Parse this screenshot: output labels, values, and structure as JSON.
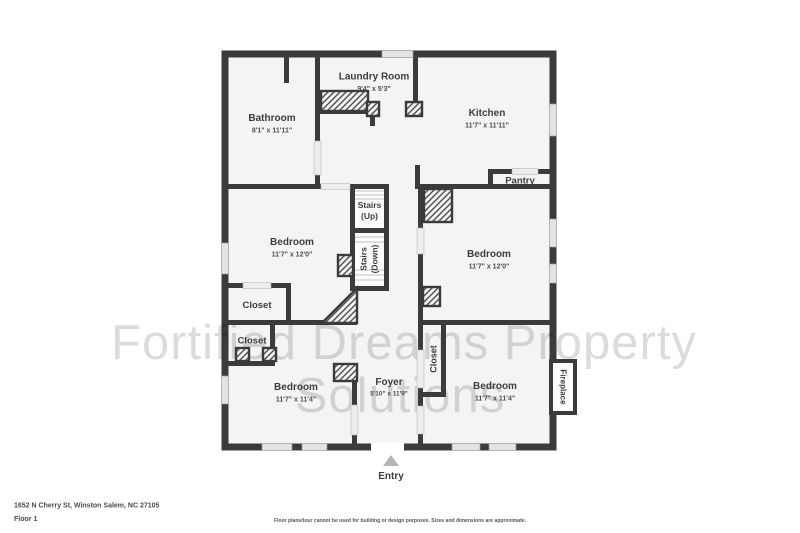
{
  "watermark": {
    "line1": "Fortified Dreams Property",
    "line2": "Solutions"
  },
  "rooms": {
    "bathroom": {
      "name": "Bathroom",
      "dims": "8'1\" x 11'11\""
    },
    "laundry": {
      "name": "Laundry Room",
      "dims": "9'4\" x 5'3\""
    },
    "kitchen": {
      "name": "Kitchen",
      "dims": "11'7\" x 11'11\""
    },
    "pantry": {
      "name": "Pantry"
    },
    "stairs_up": {
      "name": "Stairs",
      "name2": "(Up)"
    },
    "stairs_down": {
      "name": "Stairs",
      "name2": "(Down)"
    },
    "bedroom_left": {
      "name": "Bedroom",
      "dims": "11'7\" x 12'0\""
    },
    "bedroom_right": {
      "name": "Bedroom",
      "dims": "11'7\" x 12'0\""
    },
    "closet_mid": {
      "name": "Closet"
    },
    "closet_small": {
      "name": "Closet"
    },
    "bedroom_bottom_left": {
      "name": "Bedroom",
      "dims": "11'7\" x 11'4\""
    },
    "foyer": {
      "name": "Foyer",
      "dims": "5'10\" x 11'9\""
    },
    "closet_foyer": {
      "name": "Closet"
    },
    "bedroom_bottom_right": {
      "name": "Bedroom",
      "dims": "11'7\" x 11'4\""
    },
    "fireplace": {
      "name": "Fireplace"
    }
  },
  "entry": {
    "label": "Entry"
  },
  "footer": {
    "address": "1652 N Cherry St, Winston Salem, NC 27105",
    "floor_label": "Floor 1",
    "disclaimer": "Floor plans/tour cannot be used for building or design purposes. Sizes and dimensions are approximate."
  },
  "colors": {
    "wall": "#3b3b3b",
    "floor": "#f4f4f4",
    "window": "#e3e3e3",
    "watermark": "#d9d9d9",
    "entry_arrow": "#b5b5b5",
    "background": "#ffffff"
  }
}
